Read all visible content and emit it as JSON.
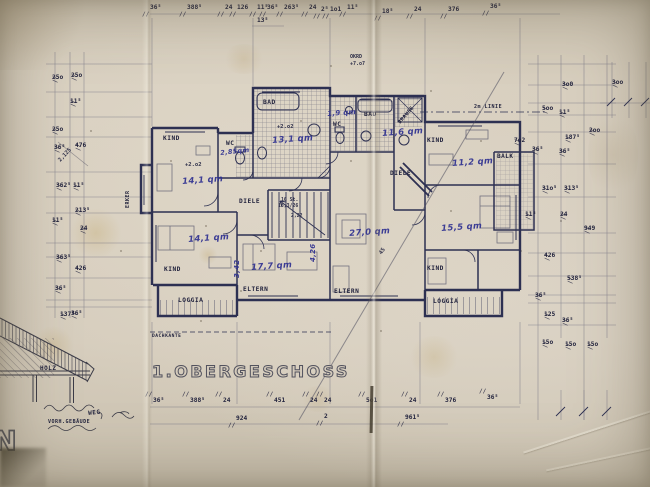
{
  "drawing": {
    "title": "1.OBERGESCHOSS",
    "rooms": [
      {
        "n": "room-kind-1",
        "t": "KIND",
        "x": 163,
        "y": 136
      },
      {
        "n": "room-wc-1",
        "t": "WC",
        "x": 226,
        "y": 141
      },
      {
        "n": "room-bad-1",
        "t": "BAD",
        "x": 263,
        "y": 100
      },
      {
        "n": "room-wc-2",
        "t": "WC",
        "x": 333,
        "y": 122
      },
      {
        "n": "room-bad-2",
        "t": "BAD",
        "x": 364,
        "y": 112
      },
      {
        "n": "room-brause",
        "t": "BRAUSE",
        "x": 398,
        "y": 122,
        "r": -50,
        "s": 5
      },
      {
        "n": "room-kind-2",
        "t": "KIND",
        "x": 427,
        "y": 138
      },
      {
        "n": "room-balk",
        "t": "BALK",
        "x": 497,
        "y": 154,
        "s": 6
      },
      {
        "n": "room-diele-1",
        "t": "DIELE",
        "x": 239,
        "y": 199
      },
      {
        "n": "room-diele-2",
        "t": "DIELE",
        "x": 390,
        "y": 171
      },
      {
        "n": "room-eltern-1",
        "t": "ELTERN",
        "x": 243,
        "y": 287
      },
      {
        "n": "room-eltern-2",
        "t": "ELTERN",
        "x": 334,
        "y": 289
      },
      {
        "n": "room-kind-3",
        "t": "KIND",
        "x": 164,
        "y": 267
      },
      {
        "n": "room-kind-4",
        "t": "KIND",
        "x": 427,
        "y": 266
      },
      {
        "n": "room-loggia-1",
        "t": "LOGGIA",
        "x": 178,
        "y": 298
      },
      {
        "n": "room-loggia-2",
        "t": "LOGGIA",
        "x": 433,
        "y": 299
      },
      {
        "n": "room-erker",
        "t": "ERKER",
        "x": 126,
        "y": 208,
        "r": -90,
        "s": 5
      },
      {
        "n": "label-dachkante",
        "t": "DACHKANTE",
        "x": 152,
        "y": 335,
        "s": 4.6
      },
      {
        "n": "label-2m-linie",
        "t": "2m LINIE",
        "x": 474,
        "y": 105,
        "s": 5
      }
    ],
    "areas": [
      {
        "n": "area-wc-1",
        "t": "2,85qm",
        "x": 220,
        "y": 150,
        "s": 6.5,
        "r": -6
      },
      {
        "n": "area-kind-1",
        "t": "14,1 qm",
        "x": 182,
        "y": 178
      },
      {
        "n": "area-bad-1",
        "t": "13,1 qm",
        "x": 272,
        "y": 137
      },
      {
        "n": "area-wc-2",
        "t": "1,9 qm",
        "x": 327,
        "y": 111,
        "s": 7
      },
      {
        "n": "area-bad-2",
        "t": "11,6 qm",
        "x": 382,
        "y": 130
      },
      {
        "n": "area-kind-2",
        "t": "11,2 qm",
        "x": 452,
        "y": 160
      },
      {
        "n": "area-kind-3",
        "t": "14,1 qm",
        "x": 188,
        "y": 236
      },
      {
        "n": "area-eltern-1",
        "t": "17,7 qm",
        "x": 251,
        "y": 264
      },
      {
        "n": "area-wohnen",
        "t": "27,0 qm",
        "x": 349,
        "y": 230
      },
      {
        "n": "area-kind-4",
        "t": "15,5 qm",
        "x": 441,
        "y": 225
      },
      {
        "n": "area-height-342",
        "t": "3,42",
        "x": 234,
        "y": 278,
        "r": -90,
        "s": 7
      },
      {
        "n": "area-height-426",
        "t": "4,26",
        "x": 310,
        "y": 262,
        "r": -90,
        "s": 7
      }
    ],
    "notes": [
      {
        "n": "note-level-1",
        "t": "+2.o2",
        "x": 185,
        "y": 163
      },
      {
        "n": "note-level-2",
        "t": "+2.o2",
        "x": 277,
        "y": 125
      },
      {
        "n": "note-stairs-count",
        "t": "16 St.",
        "x": 281,
        "y": 199,
        "s": 4.8
      },
      {
        "n": "note-stairs-ratio",
        "t": "18,3/26",
        "x": 278,
        "y": 205,
        "s": 4.8
      },
      {
        "n": "note-222",
        "t": "2,22",
        "x": 291,
        "y": 215,
        "s": 4.8
      },
      {
        "n": "note-45",
        "t": "45",
        "x": 379,
        "y": 253,
        "r": -55
      },
      {
        "n": "note-2125",
        "t": "2,125",
        "x": 58,
        "y": 160,
        "r": -47
      },
      {
        "n": "note-okrd",
        "t": "OKRD",
        "x": 350,
        "y": 55,
        "s": 5
      },
      {
        "n": "note-okrd-level",
        "t": "+7.o7",
        "x": 350,
        "y": 62,
        "s": 5
      }
    ],
    "site_labels": [
      {
        "n": "label-holz",
        "t": "HOLZ",
        "x": 40,
        "y": 366,
        "s": 6
      },
      {
        "n": "label-vorh-gebaeude",
        "t": "VORH.GEBÄUDE",
        "x": 48,
        "y": 420,
        "s": 5
      },
      {
        "n": "label-weg",
        "t": "WEG",
        "x": 88,
        "y": 411,
        "s": 6,
        "r": -6
      }
    ],
    "site_letter": "N",
    "dimensions": {
      "top": [
        {
          "t": "36⁵",
          "x": 150,
          "y": 5
        },
        {
          "t": "388⁵",
          "x": 187,
          "y": 5
        },
        {
          "t": "24",
          "x": 225,
          "y": 5
        },
        {
          "t": "126",
          "x": 237,
          "y": 5
        },
        {
          "t": "11⁵",
          "x": 257,
          "y": 5
        },
        {
          "t": "36⁵",
          "x": 267,
          "y": 5
        },
        {
          "t": "263⁵",
          "x": 284,
          "y": 5
        },
        {
          "t": "24",
          "x": 309,
          "y": 5
        },
        {
          "t": "2⁵",
          "x": 321,
          "y": 7
        },
        {
          "t": "1o1",
          "x": 330,
          "y": 7
        },
        {
          "t": "11⁵",
          "x": 347,
          "y": 5
        },
        {
          "t": "18⁵",
          "x": 382,
          "y": 9
        },
        {
          "t": "24",
          "x": 414,
          "y": 7
        },
        {
          "t": "376",
          "x": 448,
          "y": 7
        },
        {
          "t": "36⁵",
          "x": 490,
          "y": 4
        }
      ],
      "top_sub": [
        {
          "t": "13⁵",
          "x": 257,
          "y": 18
        }
      ],
      "bottom": [
        {
          "t": "36⁵",
          "x": 153,
          "y": 398
        },
        {
          "t": "388⁵",
          "x": 190,
          "y": 398
        },
        {
          "t": "24",
          "x": 223,
          "y": 398
        },
        {
          "t": "451",
          "x": 274,
          "y": 398
        },
        {
          "t": "24",
          "x": 310,
          "y": 398
        },
        {
          "t": "24",
          "x": 324,
          "y": 398
        },
        {
          "t": "5o1",
          "x": 366,
          "y": 398
        },
        {
          "t": "24",
          "x": 409,
          "y": 398
        },
        {
          "t": "376",
          "x": 445,
          "y": 398
        },
        {
          "t": "36⁵",
          "x": 487,
          "y": 395
        }
      ],
      "bottom_totals": [
        {
          "t": "924",
          "x": 236,
          "y": 416
        },
        {
          "t": "2",
          "x": 324,
          "y": 414
        },
        {
          "t": "961⁵",
          "x": 405,
          "y": 415
        }
      ],
      "left": [
        {
          "t": "25o",
          "x": 52,
          "y": 75
        },
        {
          "t": "25o",
          "x": 71,
          "y": 73
        },
        {
          "t": "11⁵",
          "x": 70,
          "y": 99
        },
        {
          "t": "25o",
          "x": 52,
          "y": 127
        },
        {
          "t": "36⁵",
          "x": 54,
          "y": 145
        },
        {
          "t": "476",
          "x": 75,
          "y": 143
        },
        {
          "t": "362⁵",
          "x": 56,
          "y": 183
        },
        {
          "t": "11⁵",
          "x": 73,
          "y": 183
        },
        {
          "t": "213⁵",
          "x": 75,
          "y": 208
        },
        {
          "t": "11⁵",
          "x": 52,
          "y": 218
        },
        {
          "t": "24",
          "x": 80,
          "y": 226
        },
        {
          "t": "363⁵",
          "x": 56,
          "y": 255
        },
        {
          "t": "426",
          "x": 75,
          "y": 266
        },
        {
          "t": "36⁵",
          "x": 55,
          "y": 286
        },
        {
          "t": "137⁵",
          "x": 60,
          "y": 312
        },
        {
          "t": "36⁵",
          "x": 71,
          "y": 311
        }
      ],
      "right": [
        {
          "t": "7o2",
          "x": 514,
          "y": 138
        },
        {
          "t": "3o0",
          "x": 562,
          "y": 82
        },
        {
          "t": "3oo",
          "x": 612,
          "y": 80
        },
        {
          "t": "5oo",
          "x": 542,
          "y": 106
        },
        {
          "t": "11⁵",
          "x": 559,
          "y": 110
        },
        {
          "t": "187⁵",
          "x": 565,
          "y": 135
        },
        {
          "t": "2oo",
          "x": 589,
          "y": 128
        },
        {
          "t": "36⁵",
          "x": 532,
          "y": 147
        },
        {
          "t": "36⁵",
          "x": 559,
          "y": 149
        },
        {
          "t": "31o⁵",
          "x": 542,
          "y": 186
        },
        {
          "t": "313⁵",
          "x": 564,
          "y": 186
        },
        {
          "t": "11⁵",
          "x": 525,
          "y": 212
        },
        {
          "t": "24",
          "x": 560,
          "y": 212
        },
        {
          "t": "949",
          "x": 584,
          "y": 226
        },
        {
          "t": "426",
          "x": 544,
          "y": 253
        },
        {
          "t": "538⁵",
          "x": 567,
          "y": 276
        },
        {
          "t": "36⁵",
          "x": 535,
          "y": 293
        },
        {
          "t": "125",
          "x": 544,
          "y": 312
        },
        {
          "t": "36⁵",
          "x": 562,
          "y": 318
        },
        {
          "t": "15o",
          "x": 542,
          "y": 340
        },
        {
          "t": "15o",
          "x": 565,
          "y": 342
        },
        {
          "t": "15o",
          "x": 587,
          "y": 342
        }
      ]
    },
    "colors": {
      "paper": "#d6cdbd",
      "ink": "#2d3052",
      "handwriting_blue": "#2f3191",
      "pencil": "#4a4a5c"
    }
  }
}
